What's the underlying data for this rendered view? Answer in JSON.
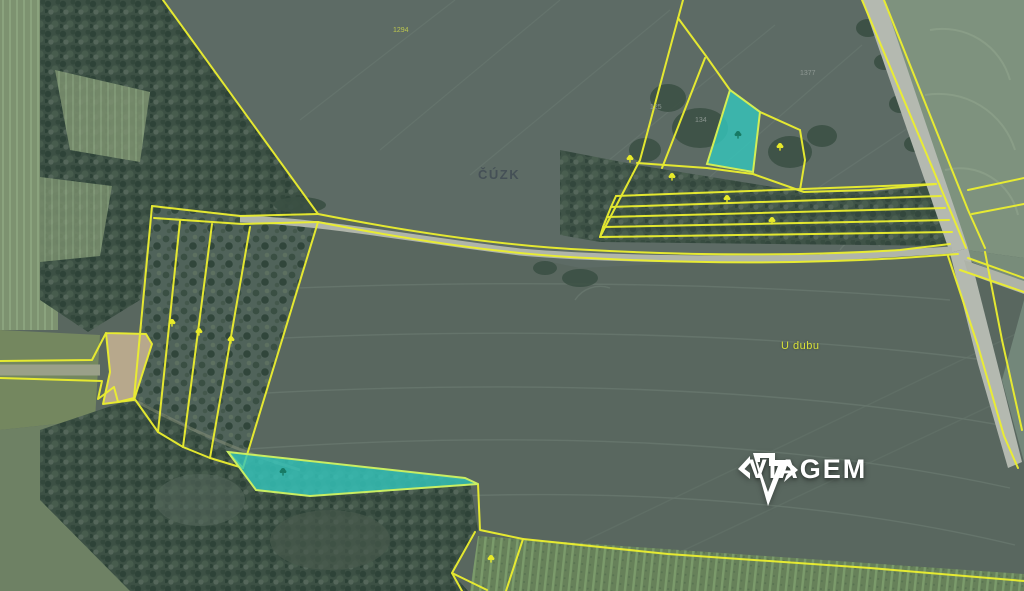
{
  "map": {
    "source_watermark": "ČÚZK",
    "place_label": "U dubu",
    "parcel_numbers": [
      "1294",
      "1377",
      "125",
      "134"
    ],
    "highlighted_parcel_count": 2,
    "colors": {
      "boundary_yellow": "#ecef2f",
      "highlight_fill": "#35c4bb",
      "highlight_border": "#c9ee62",
      "field_base": "#59675f",
      "forest": "#3c5044",
      "road": "#b4b9b0",
      "light_field": "#7e927e",
      "dirt": "#b7a88c"
    },
    "marker_icon": "deciduous-tree-icon",
    "marker_count": 11
  },
  "logo": {
    "name": "VIAGEM",
    "icon": "gem-icon"
  }
}
